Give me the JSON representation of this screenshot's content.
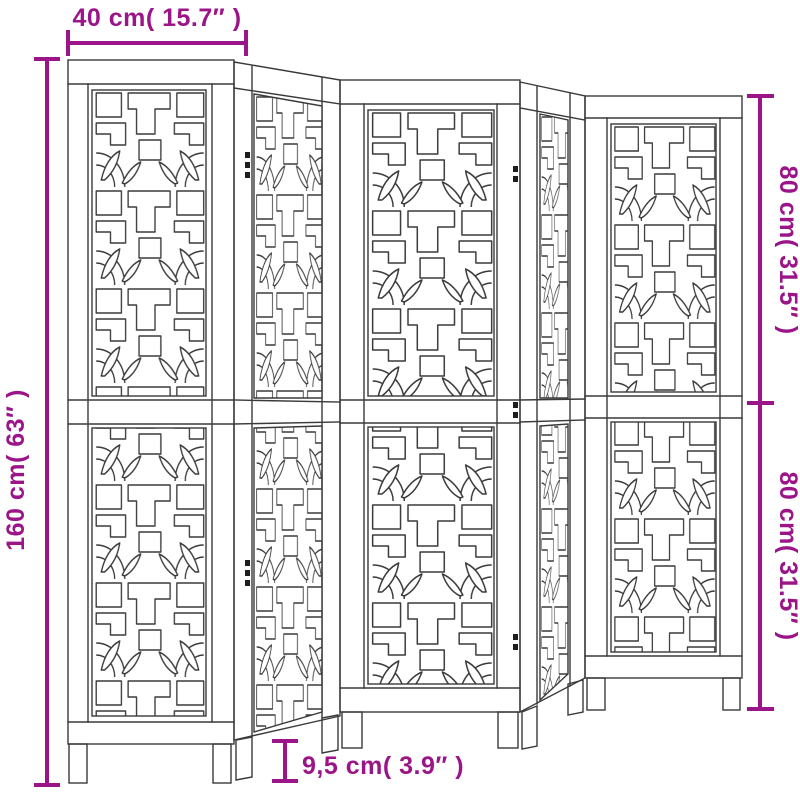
{
  "diagram": {
    "kind": "product dimension drawing",
    "product": "folding room divider screen",
    "panel_count": 5,
    "style": "oriental fret lattice with leaf fan motifs"
  },
  "dimensions": {
    "top": "40 cm( 15.7″ )",
    "left": "160 cm( 63″ )",
    "right_upper": "80 cm( 31.5″ )",
    "right_lower": "80 cm( 31.5″ )",
    "bottom": "9,5 cm( 3.9″ )"
  },
  "colors": {
    "dimension": "#9B1589",
    "line_art": "#3A3A3A",
    "background": "#FFFFFF"
  }
}
